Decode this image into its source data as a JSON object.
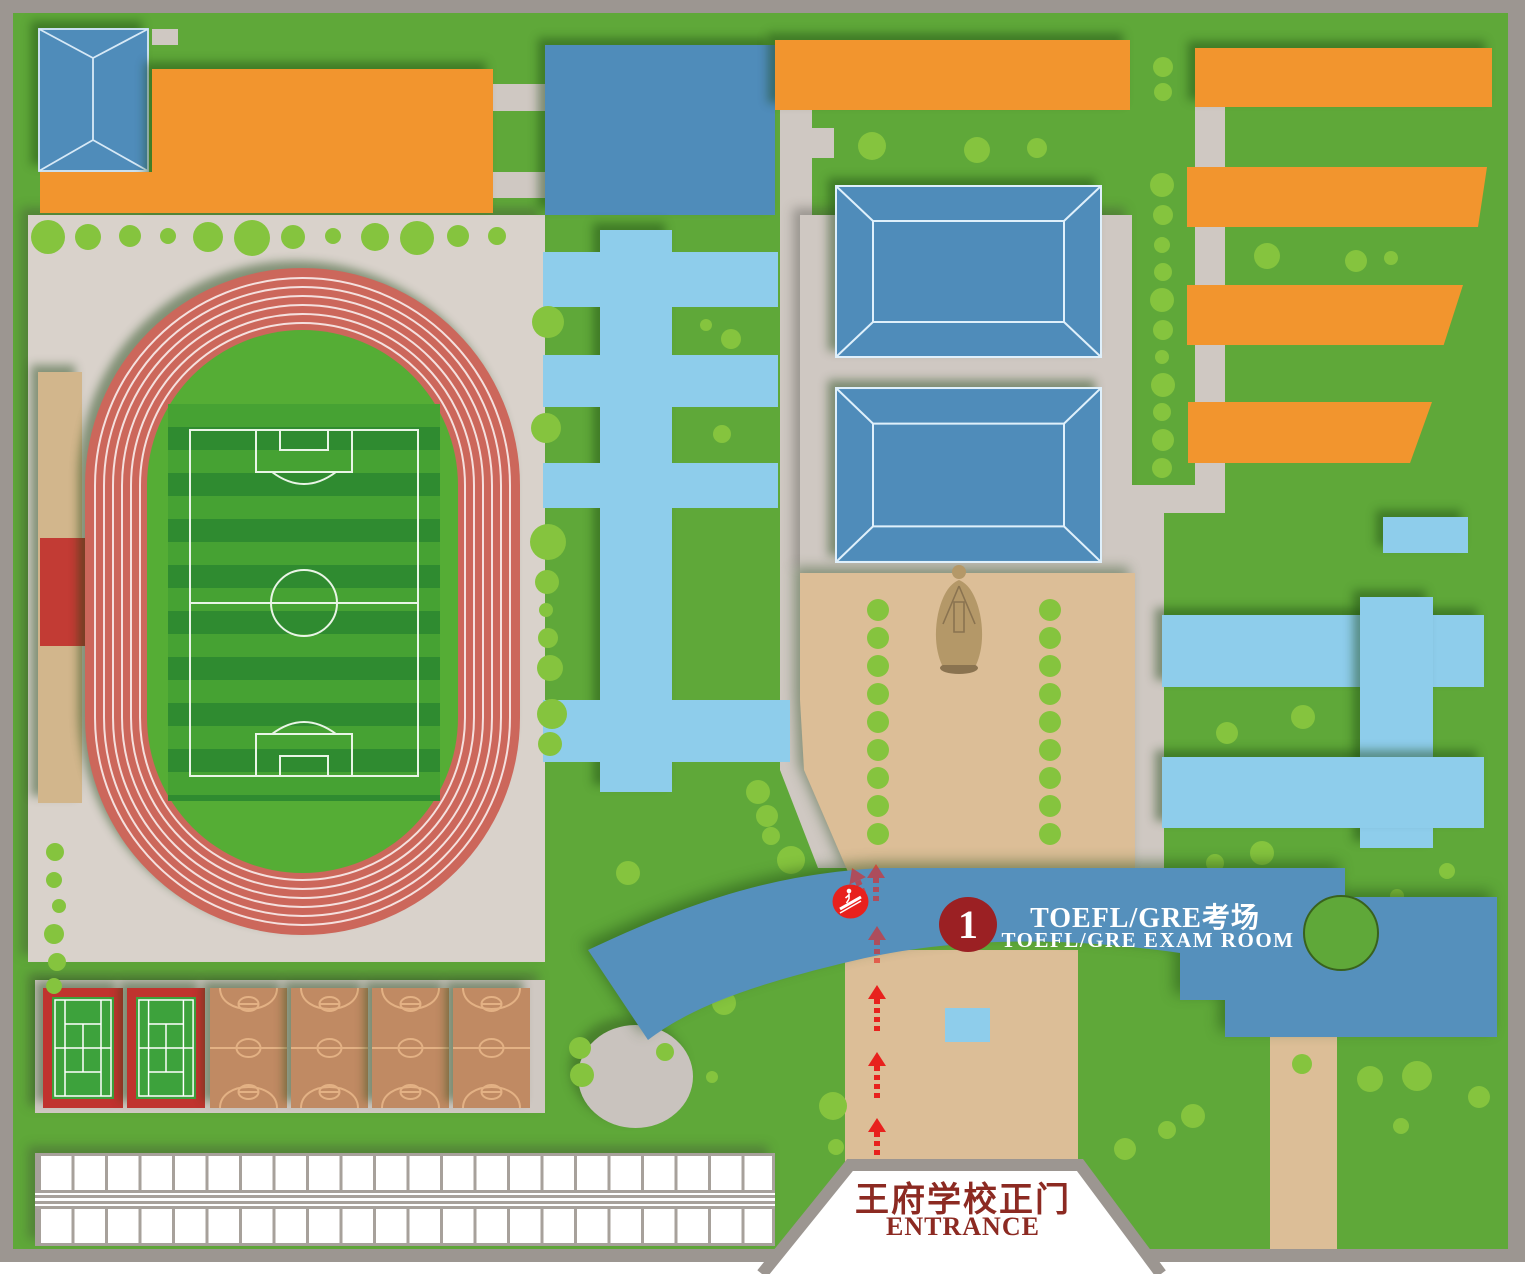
{
  "map": {
    "name": "school campus map",
    "banner": {
      "marker_number": "1",
      "title_zh": "TOEFL/GRE考场",
      "title_en": "TOEFL/GRE  EXAM  ROOM"
    },
    "entrance": {
      "label_zh": "王府学校正门",
      "label_en": "ENTRANCE"
    }
  },
  "colors": {
    "grass": "#5fa839",
    "tree": "#85c43e",
    "pathgray": "#cfc8c2",
    "trackzone": "#d9d2cb",
    "border": "#9c9691",
    "orange": "#f2952e",
    "blue": "#4f8cba",
    "roofline": "#dcecf8",
    "skyblue": "#8ecdeb",
    "bannerblue": "#5590bc",
    "tan": "#dcbe97",
    "standtan": "#d2b68c",
    "standred": "#c23b34",
    "trackred": "#cc675b",
    "fieldgreen": "#55ad35",
    "stripe1": "#46a233",
    "stripe2": "#2f8b30",
    "tennisgreen": "#3da23c",
    "courtred": "#c0332e",
    "bball": "#c08a63",
    "bballline": "#e3b184",
    "shedline": "#a7a19b",
    "arrowred": "#e8211d",
    "markerred": "#9b2023",
    "textred": "#8c2a22",
    "statue": "#b49868",
    "statueshade": "#8a7350",
    "ellipsegray": "#c9c3be",
    "notchline": "#39621d"
  },
  "decor": {
    "trees": [
      [
        48,
        237,
        17
      ],
      [
        88,
        237,
        13
      ],
      [
        130,
        236,
        11
      ],
      [
        168,
        236,
        8
      ],
      [
        208,
        237,
        15
      ],
      [
        252,
        238,
        18
      ],
      [
        293,
        237,
        12
      ],
      [
        333,
        236,
        8
      ],
      [
        375,
        237,
        14
      ],
      [
        417,
        238,
        17
      ],
      [
        458,
        236,
        11
      ],
      [
        497,
        236,
        9
      ],
      [
        55,
        852,
        9
      ],
      [
        54,
        880,
        8
      ],
      [
        59,
        906,
        7
      ],
      [
        54,
        934,
        10
      ],
      [
        57,
        962,
        9
      ],
      [
        54,
        986,
        8
      ],
      [
        548,
        322,
        16
      ],
      [
        546,
        428,
        15
      ],
      [
        548,
        542,
        18
      ],
      [
        547,
        582,
        12
      ],
      [
        546,
        610,
        7
      ],
      [
        548,
        638,
        10
      ],
      [
        550,
        668,
        13
      ],
      [
        552,
        714,
        15
      ],
      [
        550,
        744,
        12
      ],
      [
        706,
        325,
        6
      ],
      [
        731,
        339,
        10
      ],
      [
        722,
        434,
        9
      ],
      [
        758,
        792,
        12
      ],
      [
        767,
        816,
        11
      ],
      [
        771,
        836,
        9
      ],
      [
        791,
        860,
        14
      ],
      [
        628,
        873,
        12
      ],
      [
        580,
        1048,
        11
      ],
      [
        665,
        1052,
        9
      ],
      [
        582,
        1075,
        12
      ],
      [
        712,
        1077,
        6
      ],
      [
        833,
        1106,
        14
      ],
      [
        836,
        1147,
        8
      ],
      [
        724,
        1003,
        12
      ],
      [
        764,
        967,
        9
      ],
      [
        872,
        146,
        14
      ],
      [
        977,
        150,
        13
      ],
      [
        1037,
        148,
        10
      ],
      [
        1163,
        67,
        10
      ],
      [
        1163,
        92,
        9
      ],
      [
        1162,
        185,
        12
      ],
      [
        1163,
        215,
        10
      ],
      [
        1162,
        245,
        8
      ],
      [
        1163,
        272,
        9
      ],
      [
        1162,
        300,
        12
      ],
      [
        1163,
        330,
        10
      ],
      [
        1162,
        357,
        7
      ],
      [
        1163,
        385,
        12
      ],
      [
        1162,
        412,
        9
      ],
      [
        1163,
        440,
        11
      ],
      [
        1162,
        468,
        10
      ],
      [
        1267,
        256,
        13
      ],
      [
        1356,
        261,
        11
      ],
      [
        1391,
        258,
        7
      ],
      [
        878,
        610,
        11
      ],
      [
        878,
        638,
        11
      ],
      [
        878,
        666,
        11
      ],
      [
        878,
        694,
        11
      ],
      [
        878,
        722,
        11
      ],
      [
        878,
        750,
        11
      ],
      [
        878,
        778,
        11
      ],
      [
        878,
        806,
        11
      ],
      [
        878,
        834,
        11
      ],
      [
        1050,
        610,
        11
      ],
      [
        1050,
        638,
        11
      ],
      [
        1050,
        666,
        11
      ],
      [
        1050,
        694,
        11
      ],
      [
        1050,
        722,
        11
      ],
      [
        1050,
        750,
        11
      ],
      [
        1050,
        778,
        11
      ],
      [
        1050,
        806,
        11
      ],
      [
        1050,
        834,
        11
      ],
      [
        1227,
        733,
        11
      ],
      [
        1303,
        717,
        12
      ],
      [
        1262,
        853,
        12
      ],
      [
        1215,
        863,
        9
      ],
      [
        1447,
        871,
        8
      ],
      [
        1397,
        896,
        7
      ],
      [
        1370,
        1079,
        13
      ],
      [
        1417,
        1076,
        15
      ],
      [
        1479,
        1097,
        11
      ],
      [
        1401,
        1126,
        8
      ],
      [
        1193,
        1116,
        12
      ],
      [
        1167,
        1130,
        9
      ],
      [
        1125,
        1149,
        11
      ],
      [
        1302,
        1064,
        10
      ]
    ],
    "arrows": [
      [
        852,
        868,
        30,
        -24,
        0.6
      ],
      [
        876,
        864,
        40,
        0,
        0.6
      ],
      [
        877,
        926,
        38,
        0,
        0.6
      ],
      [
        877,
        985,
        46,
        0,
        1
      ],
      [
        877,
        1052,
        46,
        0,
        1
      ],
      [
        877,
        1118,
        46,
        0,
        1
      ]
    ]
  }
}
